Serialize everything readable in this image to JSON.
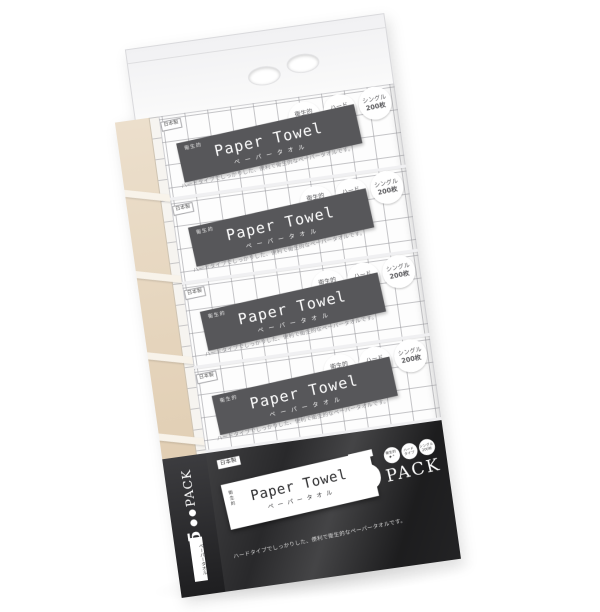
{
  "package": {
    "made_in": "日本製",
    "pack": {
      "label_small": "衛生的",
      "title": "Paper Towel",
      "subtitle": "ペーパータオル",
      "tagline": "ハードタイプでしっかりした、便利で衛生的なペーパータオルです。",
      "badges": [
        {
          "top": "衛生的",
          "bottom": "✦⁺"
        },
        {
          "top": "ハード",
          "bottom": "タイプ"
        },
        {
          "top": "シングル",
          "bottom": "200枚"
        }
      ]
    },
    "band": {
      "made_in": "日本製",
      "label_small": "衛生的",
      "title": "Paper Towel",
      "subtitle": "ペーパータオル",
      "count": "5",
      "count_unit": "PACK",
      "tagline": "ハードタイプでしっかりした、便利で衛生的なペーパータオルです。"
    },
    "side": {
      "count": "5",
      "count_unit": "PACK",
      "tag": "ペーパータオル"
    },
    "colors": {
      "band_dark": "#29292b",
      "label_gray": "#57575a",
      "side_beige": "#ddc8aa",
      "grid_line": "#96969b"
    }
  }
}
